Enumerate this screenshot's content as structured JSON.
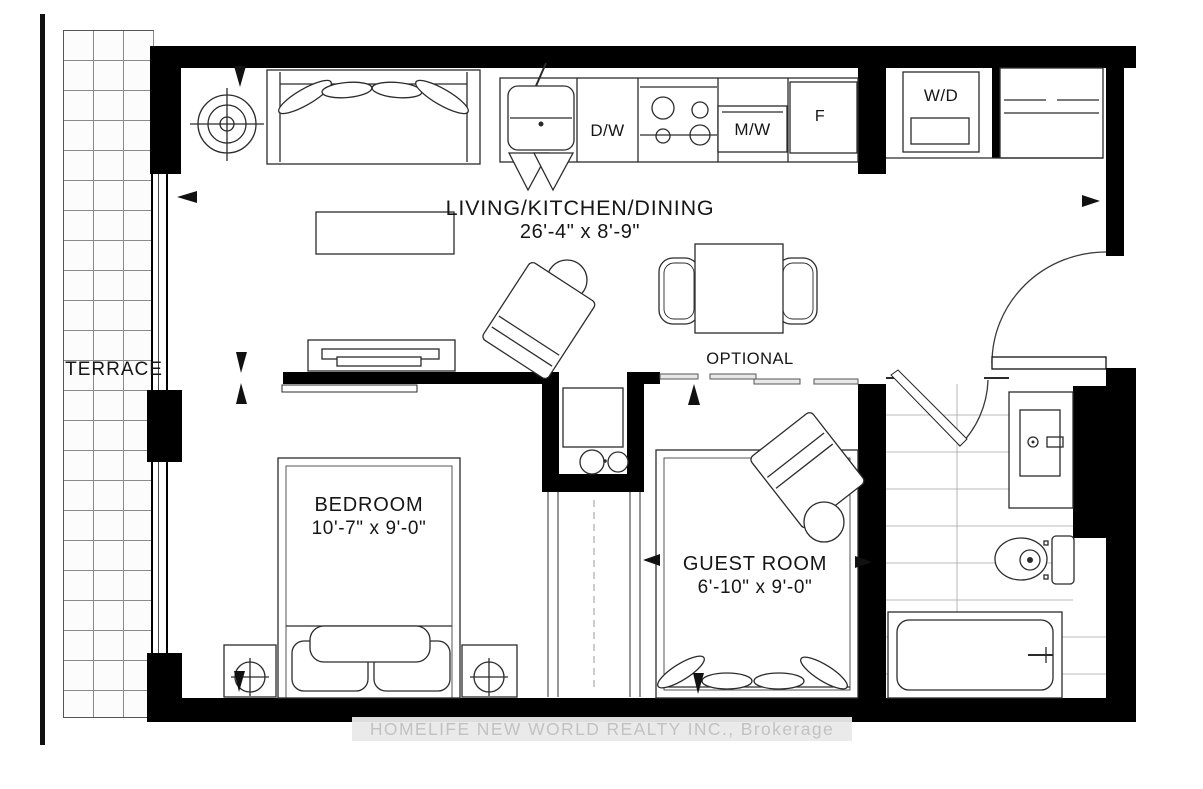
{
  "watermark": {
    "text": "HOMELIFE NEW WORLD REALTY INC., Brokerage"
  },
  "rooms": {
    "living": {
      "name": "LIVING/KITCHEN/DINING",
      "dims": "26'-4\" x 8'-9\""
    },
    "bedroom": {
      "name": "BEDROOM",
      "dims": "10'-7\" x 9'-0\""
    },
    "guest": {
      "name": "GUEST ROOM",
      "dims": "6'-10\" x 9'-0\""
    },
    "terrace": {
      "name": "TERRACE"
    }
  },
  "labels": {
    "optional": "OPTIONAL"
  },
  "appliances": {
    "dishwasher": "D/W",
    "microwave": "M/W",
    "fridge": "F",
    "washer_dryer": "W/D"
  },
  "colors": {
    "wall": "#000000",
    "line": "#2b2b2b",
    "tile_line": "#999999",
    "watermark_text": "#c2c2c2"
  }
}
